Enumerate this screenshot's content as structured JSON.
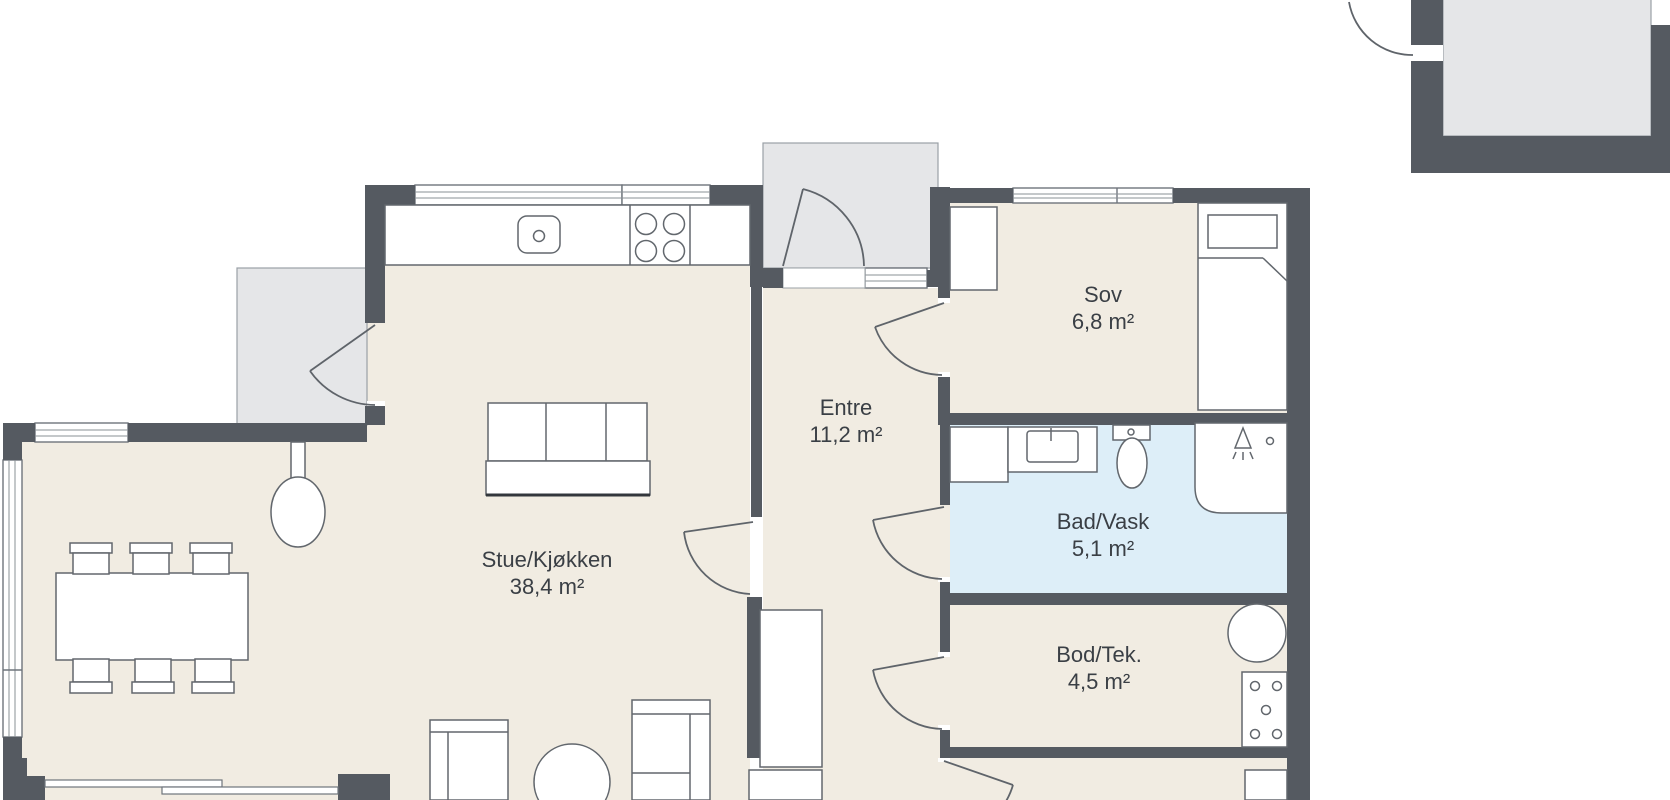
{
  "title": "Floor plan",
  "rooms": [
    {
      "id": "stue",
      "name": "Stue/Kjøkken",
      "area": "38,4 m²"
    },
    {
      "id": "entre",
      "name": "Entre",
      "area": "11,2 m²"
    },
    {
      "id": "sov",
      "name": "Sov",
      "area": "6,8 m²"
    },
    {
      "id": "bad",
      "name": "Bad/Vask",
      "area": "5,1 m²"
    },
    {
      "id": "bod",
      "name": "Bod/Tek.",
      "area": "4,5 m²"
    }
  ],
  "colors": {
    "wall": "#555a61",
    "floor": "#f1ece2",
    "bathroom_floor": "#ddeef8",
    "outdoor_area": "#e5e6e8",
    "furniture_outline": "#62676d",
    "label_text": "#3a3f45",
    "background": "#ffffff"
  },
  "fixtures": [
    "kitchen-counter",
    "kitchen-sink-icon",
    "stove-burners-icon",
    "pendant-lamp",
    "dining-table",
    "dining-chairs",
    "sofa",
    "armchair",
    "coffee-table",
    "sliding-door",
    "entre-closet",
    "sov-wardrobe",
    "bed",
    "washing-machine-icon",
    "vanity-sink-icon",
    "toilet-icon",
    "shower-icon",
    "water-heater-icon",
    "electrical-panel-icon"
  ]
}
